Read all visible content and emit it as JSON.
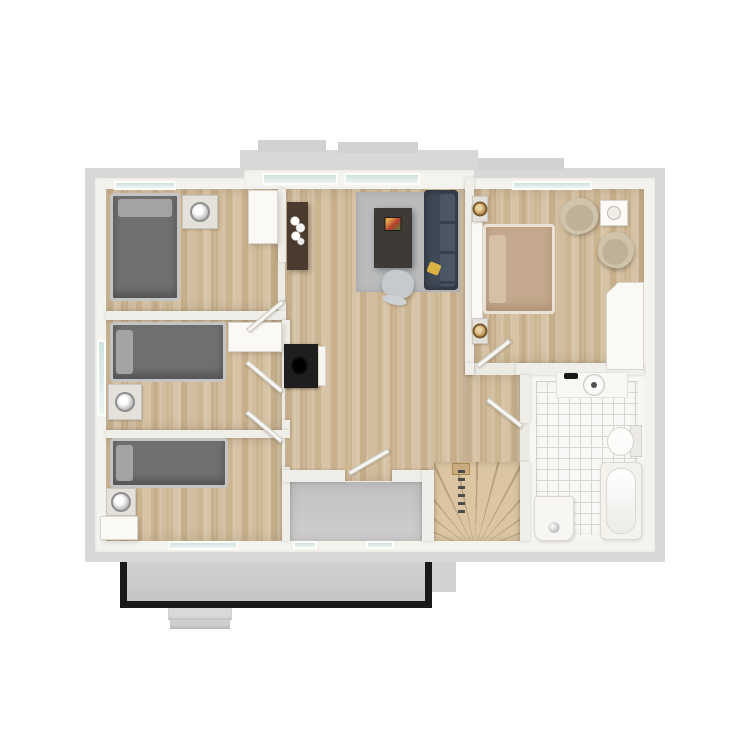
{
  "palette": {
    "background": "#ffffff",
    "roof_overhang": "#d8d8d8",
    "exterior_wall": "#f4f3ee",
    "interior_wall": "#f0eee8",
    "wood_floor": "#d3bfa0",
    "stairs_wood": "#dcc6a2",
    "tile_floor": "#f8f8f6",
    "concrete_gray": "#c8c8c8",
    "bed_gray": "#707070",
    "bed_tan": "#c4a98e",
    "sofa_navy": "#3f4956",
    "sideboard_brown": "#4b3a2e",
    "accent_yellow": "#d9b244",
    "railing_black": "#1a1a1a",
    "window_glass": "#cfe2df"
  },
  "rooms": [
    {
      "name": "bedroom-top-left",
      "floor": "wood"
    },
    {
      "name": "bedroom-middle-left",
      "floor": "wood"
    },
    {
      "name": "bedroom-bottom-left",
      "floor": "wood"
    },
    {
      "name": "living-room",
      "floor": "wood"
    },
    {
      "name": "hallway",
      "floor": "wood"
    },
    {
      "name": "master-bedroom",
      "floor": "wood"
    },
    {
      "name": "bathroom",
      "floor": "tile"
    },
    {
      "name": "loggia",
      "floor": "concrete"
    },
    {
      "name": "staircase",
      "floor": "wood"
    },
    {
      "name": "balcony",
      "floor": "concrete"
    }
  ],
  "plan": {
    "render_order": [
      "roof",
      "shell",
      "floors",
      "walls",
      "windows",
      "furniture",
      "doors"
    ],
    "roof": [
      {
        "n": "roof-overhang-main",
        "t": "roof",
        "x": 85,
        "y": 168,
        "w": 580,
        "h": 394
      },
      {
        "n": "roof-bay-band",
        "t": "roof",
        "x": 240,
        "y": 150,
        "w": 238,
        "h": 20
      },
      {
        "n": "roof-bay-step-left",
        "t": "roof-dark",
        "x": 258,
        "y": 140,
        "w": 68,
        "h": 12
      },
      {
        "n": "roof-bay-step-right",
        "t": "roof-dark",
        "x": 338,
        "y": 142,
        "w": 80,
        "h": 11
      },
      {
        "n": "roof-shoulder-right",
        "t": "roof-dark",
        "x": 478,
        "y": 158,
        "w": 86,
        "h": 12
      },
      {
        "n": "roof-stub-bottom",
        "t": "roof-dark",
        "x": 430,
        "y": 562,
        "w": 26,
        "h": 30
      }
    ],
    "shell": [
      {
        "n": "exterior-wall-band",
        "t": "shell",
        "x": 95,
        "y": 178,
        "w": 560,
        "h": 374
      },
      {
        "n": "bay-wall-band",
        "t": "shell",
        "x": 244,
        "y": 170,
        "w": 230,
        "h": 20
      },
      {
        "n": "interior-base",
        "t": "base",
        "x": 106,
        "y": 189,
        "w": 538,
        "h": 352
      },
      {
        "n": "balcony",
        "t": "balcony",
        "x": 120,
        "y": 562,
        "w": 312,
        "h": 46
      },
      {
        "n": "balcony-step-upper",
        "t": "step",
        "x": 168,
        "y": 608,
        "w": 64,
        "h": 12
      },
      {
        "n": "balcony-step-lower",
        "t": "step step2",
        "x": 170,
        "y": 620,
        "w": 60,
        "h": 9
      }
    ],
    "floors": [
      {
        "n": "floor-bedroom-top-left",
        "t": "floor-wood",
        "x": 106,
        "y": 189,
        "w": 172,
        "h": 122
      },
      {
        "n": "floor-bedroom-middle-left",
        "t": "floor-wood",
        "x": 106,
        "y": 320,
        "w": 176,
        "h": 110
      },
      {
        "n": "floor-bedroom-bottom-left",
        "t": "floor-wood",
        "x": 106,
        "y": 438,
        "w": 176,
        "h": 103
      },
      {
        "n": "floor-living-room",
        "t": "floor-wood",
        "x": 285,
        "y": 189,
        "w": 180,
        "h": 292
      },
      {
        "n": "floor-hallway",
        "t": "floor-wood",
        "x": 465,
        "y": 375,
        "w": 55,
        "h": 106
      },
      {
        "n": "floor-master-bedroom",
        "t": "floor-wood",
        "x": 474,
        "y": 189,
        "w": 170,
        "h": 174
      },
      {
        "n": "floor-bathroom",
        "t": "floor-tile",
        "x": 530,
        "y": 375,
        "w": 114,
        "h": 166
      },
      {
        "n": "floor-loggia",
        "t": "floor-gray",
        "x": 290,
        "y": 482,
        "w": 132,
        "h": 59
      },
      {
        "n": "floor-staircase",
        "t": "floor-wood-light",
        "x": 434,
        "y": 462,
        "w": 86,
        "h": 79
      }
    ],
    "walls": [
      {
        "n": "wall-bed1-living-upper",
        "t": "wall",
        "x": 278,
        "y": 189,
        "w": 8,
        "h": 73
      },
      {
        "n": "wall-bed1-living-lower",
        "t": "wall",
        "x": 278,
        "y": 302,
        "w": 8,
        "h": 9
      },
      {
        "n": "wall-bed1-bed2",
        "t": "wall",
        "x": 106,
        "y": 311,
        "w": 180,
        "h": 9
      },
      {
        "n": "wall-bed2-hall-upper",
        "t": "wall",
        "x": 282,
        "y": 320,
        "w": 8,
        "h": 68
      },
      {
        "n": "wall-bed2-hall-lower",
        "t": "wall",
        "x": 282,
        "y": 420,
        "w": 8,
        "h": 10
      },
      {
        "n": "wall-bed2-bed3",
        "t": "wall",
        "x": 106,
        "y": 430,
        "w": 184,
        "h": 8
      },
      {
        "n": "wall-bed3-loggia",
        "t": "wall",
        "x": 282,
        "y": 467,
        "w": 8,
        "h": 74
      },
      {
        "n": "wall-living-master",
        "t": "wall",
        "x": 465,
        "y": 178,
        "w": 9,
        "h": 197
      },
      {
        "n": "wall-master-bath-right",
        "t": "wall",
        "x": 516,
        "y": 363,
        "w": 128,
        "h": 12
      },
      {
        "n": "wall-master-bath-corner",
        "t": "wall",
        "x": 465,
        "y": 363,
        "w": 9,
        "h": 12
      },
      {
        "n": "wall-bath-left-upper",
        "t": "wall",
        "x": 520,
        "y": 375,
        "w": 10,
        "h": 48
      },
      {
        "n": "wall-bath-left-lower",
        "t": "wall",
        "x": 520,
        "y": 462,
        "w": 10,
        "h": 79
      },
      {
        "n": "wall-loggia-top-left",
        "t": "wall",
        "x": 282,
        "y": 470,
        "w": 63,
        "h": 12
      },
      {
        "n": "wall-loggia-top-right",
        "t": "wall",
        "x": 392,
        "y": 470,
        "w": 38,
        "h": 12
      },
      {
        "n": "wall-loggia-stairs",
        "t": "wall",
        "x": 422,
        "y": 470,
        "w": 12,
        "h": 71
      }
    ],
    "windows": [
      {
        "n": "window-bedroom1-top",
        "t": "window",
        "x": 114,
        "y": 181,
        "w": 62,
        "h": 9
      },
      {
        "n": "window-living-bay-left",
        "t": "window",
        "x": 262,
        "y": 173,
        "w": 76,
        "h": 12
      },
      {
        "n": "window-living-bay-right",
        "t": "window",
        "x": 344,
        "y": 173,
        "w": 76,
        "h": 12
      },
      {
        "n": "window-master-top",
        "t": "window",
        "x": 512,
        "y": 181,
        "w": 80,
        "h": 9
      },
      {
        "n": "window-bedroom2-left",
        "t": "window",
        "x": 97,
        "y": 340,
        "w": 9,
        "h": 76
      },
      {
        "n": "window-bedroom3-bottom",
        "t": "window",
        "x": 168,
        "y": 541,
        "w": 70,
        "h": 9
      },
      {
        "n": "window-loggia-bottom-left",
        "t": "window",
        "x": 293,
        "y": 541,
        "w": 24,
        "h": 8
      },
      {
        "n": "window-loggia-bottom-right",
        "t": "window",
        "x": 366,
        "y": 541,
        "w": 28,
        "h": 8
      }
    ],
    "furniture": [
      {
        "n": "bed-single-1",
        "t": "bed bed-v",
        "x": 110,
        "y": 193,
        "w": 70,
        "h": 108
      },
      {
        "n": "nightstand-1",
        "t": "nightstand",
        "x": 182,
        "y": 195,
        "w": 36,
        "h": 34
      },
      {
        "n": "wardrobe-bedroom1",
        "t": "case",
        "x": 248,
        "y": 190,
        "w": 30,
        "h": 54
      },
      {
        "n": "bed-single-2",
        "t": "bed bed-h",
        "x": 110,
        "y": 322,
        "w": 116,
        "h": 60
      },
      {
        "n": "nightstand-2",
        "t": "nightstand",
        "x": 108,
        "y": 384,
        "w": 34,
        "h": 36
      },
      {
        "n": "closet-bedroom2",
        "t": "case",
        "x": 228,
        "y": 322,
        "w": 54,
        "h": 30
      },
      {
        "n": "bed-single-3",
        "t": "bed bed-h",
        "x": 110,
        "y": 438,
        "w": 118,
        "h": 50
      },
      {
        "n": "nightstand-3",
        "t": "nightstand",
        "x": 106,
        "y": 488,
        "w": 30,
        "h": 28
      },
      {
        "n": "dresser-bedroom3",
        "t": "case",
        "x": 100,
        "y": 516,
        "w": 38,
        "h": 24
      },
      {
        "n": "sideboard-living",
        "t": "sideboard",
        "x": 287,
        "y": 202,
        "w": 21,
        "h": 68
      },
      {
        "n": "rug-living",
        "t": "rug",
        "x": 356,
        "y": 192,
        "w": 104,
        "h": 100
      },
      {
        "n": "desk-living",
        "t": "desk",
        "x": 374,
        "y": 208,
        "w": 38,
        "h": 60
      },
      {
        "n": "desk-chair",
        "t": "chair",
        "x": 382,
        "y": 270,
        "w": 32,
        "h": 28,
        "rot": 12
      },
      {
        "n": "sofa-living",
        "t": "sofa",
        "x": 424,
        "y": 190,
        "w": 34,
        "h": 100
      },
      {
        "n": "wall-fireplace",
        "t": "fireplace",
        "x": 284,
        "y": 344,
        "w": 34,
        "h": 44
      },
      {
        "n": "fireplace-side-panel",
        "t": "panel",
        "x": 318,
        "y": 346,
        "w": 8,
        "h": 40
      },
      {
        "n": "headboard-master",
        "t": "case",
        "x": 471,
        "y": 206,
        "w": 12,
        "h": 126
      },
      {
        "n": "bed-master",
        "t": "bed bed-h bed-tan",
        "x": 483,
        "y": 224,
        "w": 72,
        "h": 90
      },
      {
        "n": "nightstand-master-top",
        "t": "nightstand nightstand-gold",
        "x": 472,
        "y": 196,
        "w": 16,
        "h": 26
      },
      {
        "n": "nightstand-master-bottom",
        "t": "nightstand nightstand-gold",
        "x": 472,
        "y": 318,
        "w": 16,
        "h": 26
      },
      {
        "n": "armchair-master-1",
        "t": "armchair",
        "x": 560,
        "y": 198,
        "w": 38,
        "h": 36,
        "rot": -18
      },
      {
        "n": "armchair-master-2",
        "t": "armchair",
        "x": 598,
        "y": 232,
        "w": 36,
        "h": 36,
        "rot": 20
      },
      {
        "n": "side-table-master",
        "t": "sidetable",
        "x": 600,
        "y": 200,
        "w": 28,
        "h": 26
      },
      {
        "n": "wardrobe-master",
        "t": "case chamfer",
        "x": 606,
        "y": 282,
        "w": 38,
        "h": 88
      },
      {
        "n": "shower-tray",
        "t": "shower",
        "x": 556,
        "y": 372,
        "w": 72,
        "h": 26
      },
      {
        "n": "shower-drain",
        "t": "drain",
        "x": 583,
        "y": 374,
        "w": 22,
        "h": 22
      },
      {
        "n": "shower-fitting",
        "t": "fitting",
        "x": 564,
        "y": 373,
        "w": 14,
        "h": 6
      },
      {
        "n": "toilet",
        "t": "toilet",
        "x": 606,
        "y": 424,
        "w": 36,
        "h": 34
      },
      {
        "n": "bathtub",
        "t": "bathtub",
        "x": 600,
        "y": 462,
        "w": 42,
        "h": 78
      },
      {
        "n": "sink",
        "t": "sink",
        "x": 534,
        "y": 496,
        "w": 40,
        "h": 45
      },
      {
        "n": "stair-newel",
        "t": "newel",
        "x": 452,
        "y": 463,
        "w": 18,
        "h": 12
      },
      {
        "n": "stair-railing",
        "t": "rail",
        "x": 458,
        "y": 470,
        "w": 7,
        "h": 44
      }
    ],
    "doors": [
      {
        "n": "door-bedroom1",
        "t": "door",
        "x": 237,
        "y": 299,
        "w": 46,
        "h": 5,
        "origin": "100% 50%",
        "rot": -40
      },
      {
        "n": "door-bedroom2",
        "t": "door",
        "x": 236,
        "y": 389,
        "w": 46,
        "h": 5,
        "origin": "100% 50%",
        "rot": 40
      },
      {
        "n": "door-bedroom3",
        "t": "door",
        "x": 236,
        "y": 439,
        "w": 46,
        "h": 5,
        "origin": "100% 50%",
        "rot": 40
      },
      {
        "n": "door-loggia",
        "t": "door",
        "x": 349,
        "y": 471,
        "w": 46,
        "h": 5,
        "origin": "0% 50%",
        "rot": -30
      },
      {
        "n": "door-master",
        "t": "door",
        "x": 477,
        "y": 364,
        "w": 42,
        "h": 5,
        "origin": "0% 50%",
        "rot": -38
      },
      {
        "n": "door-bathroom",
        "t": "door",
        "x": 478,
        "y": 424,
        "w": 44,
        "h": 5,
        "origin": "100% 50%",
        "rot": 38
      }
    ]
  }
}
